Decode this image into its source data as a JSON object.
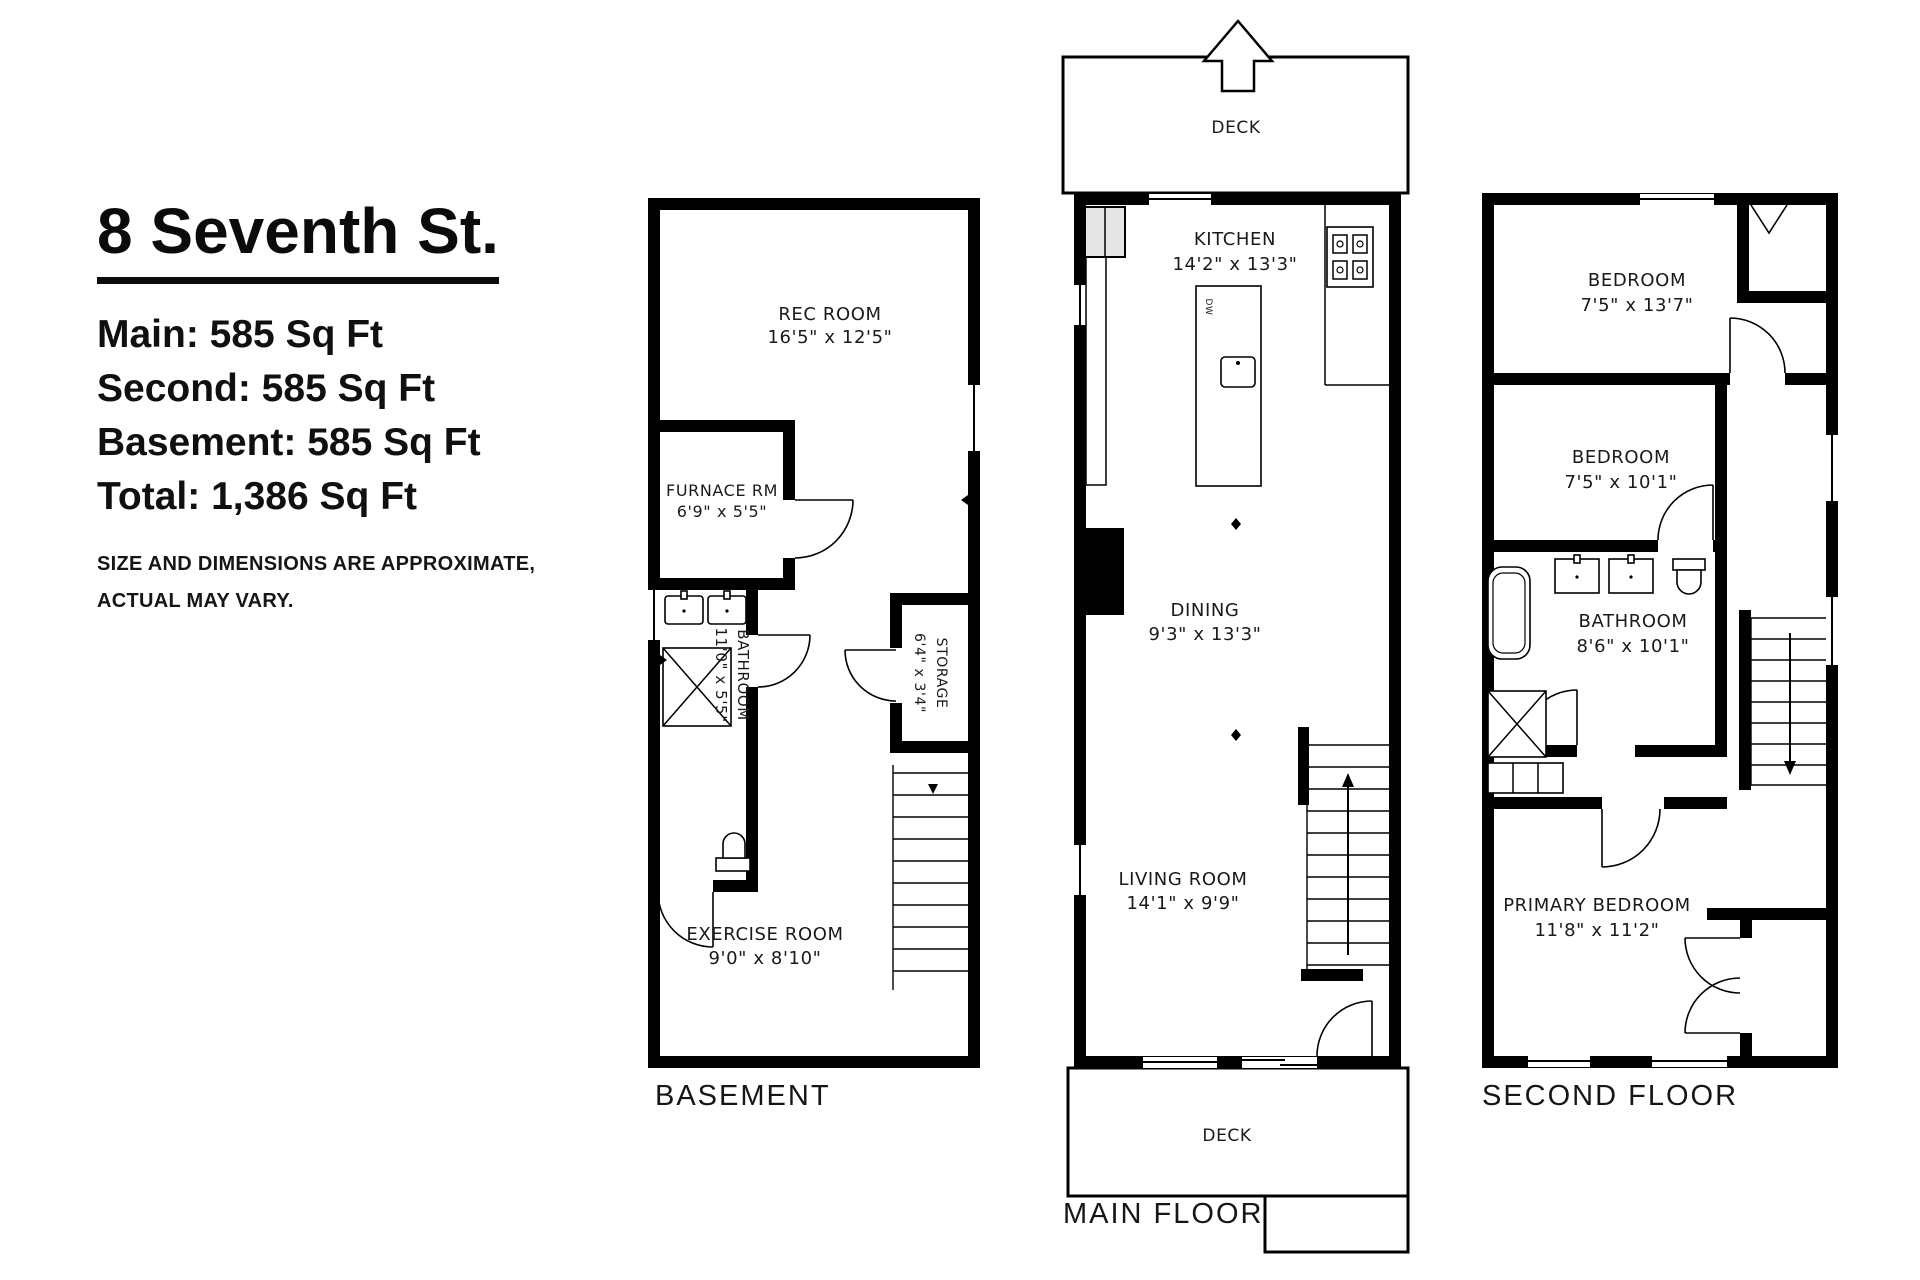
{
  "title": "8 Seventh St.",
  "stats": [
    "Main: 585 Sq Ft",
    "Second: 585 Sq Ft",
    "Basement: 585 Sq Ft",
    "Total: 1,386 Sq Ft"
  ],
  "disclaimer_line1": "SIZE AND DIMENSIONS ARE APPROXIMATE,",
  "disclaimer_line2": "ACTUAL MAY VARY.",
  "colors": {
    "line": "#000000",
    "background": "#ffffff",
    "text": "#1a1a1a"
  },
  "floors": {
    "basement": {
      "label": "BASEMENT",
      "rooms": {
        "rec": {
          "name": "REC ROOM",
          "dims": "16'5\" x 12'5\""
        },
        "furnace": {
          "name": "FURNACE RM",
          "dims": "6'9\" x 5'5\""
        },
        "bathroom": {
          "name": "BATHROOM",
          "dims": "11'0\" x 5'5\""
        },
        "storage": {
          "name": "STORAGE",
          "dims": "6'4\" x 3'4\""
        },
        "exercise": {
          "name": "EXERCISE ROOM",
          "dims": "9'0\" x 8'10\""
        }
      }
    },
    "main": {
      "label": "MAIN FLOOR",
      "deck_top": "DECK",
      "deck_bottom": "DECK",
      "dw_label": "DW",
      "rooms": {
        "kitchen": {
          "name": "KITCHEN",
          "dims": "14'2\" x 13'3\""
        },
        "dining": {
          "name": "DINING",
          "dims": "9'3\" x 13'3\""
        },
        "living": {
          "name": "LIVING ROOM",
          "dims": "14'1\" x 9'9\""
        }
      }
    },
    "second": {
      "label": "SECOND FLOOR",
      "rooms": {
        "bedroom1": {
          "name": "BEDROOM",
          "dims": "7'5\" x 13'7\""
        },
        "bedroom2": {
          "name": "BEDROOM",
          "dims": "7'5\" x 10'1\""
        },
        "bathroom": {
          "name": "BATHROOM",
          "dims": "8'6\" x 10'1\""
        },
        "primary": {
          "name": "PRIMARY BEDROOM",
          "dims": "11'8\" x 11'2\""
        }
      }
    }
  }
}
